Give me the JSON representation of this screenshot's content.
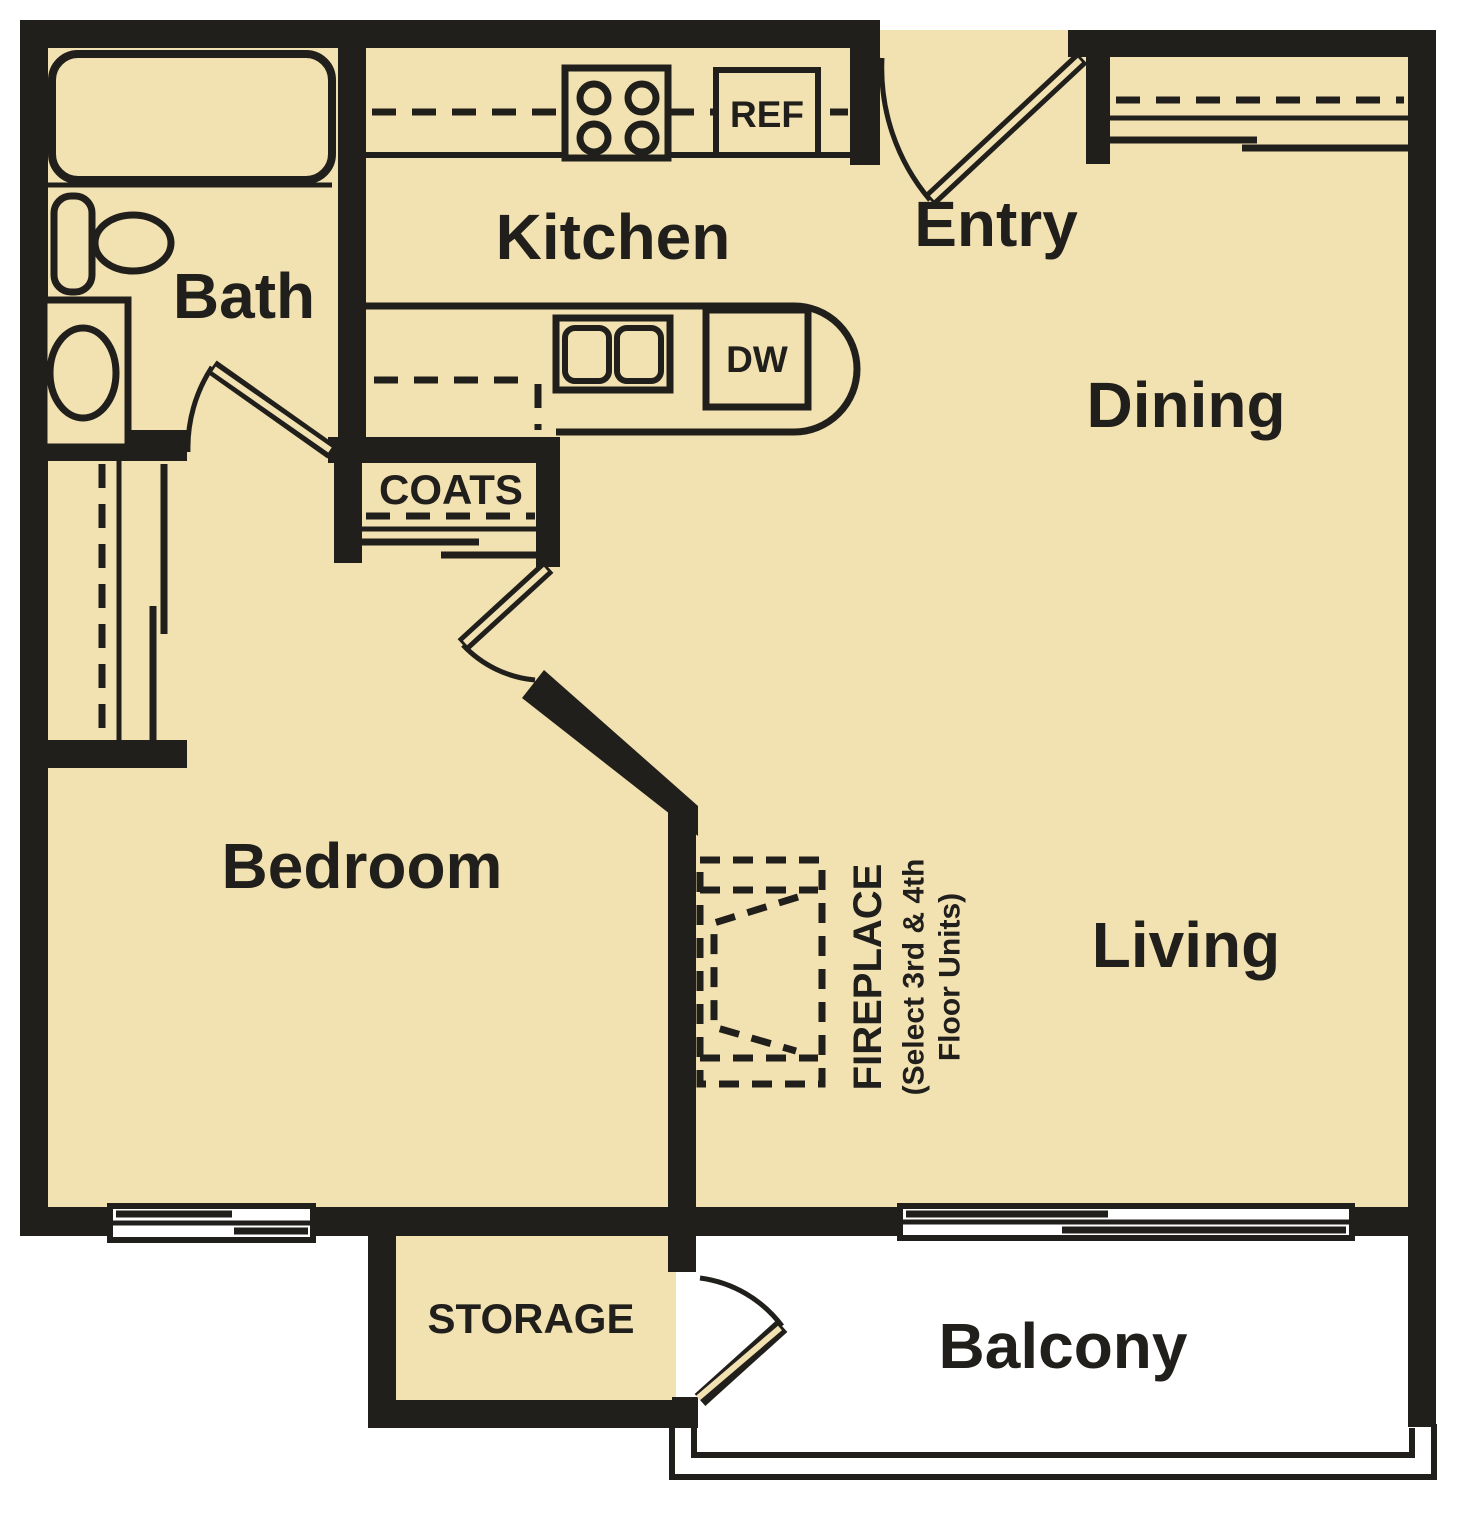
{
  "colors": {
    "floor": "#F2E2B1",
    "wall": "#211F1B",
    "line": "#211F1B",
    "outside": "#FFFFFF"
  },
  "labels": {
    "bath": "Bath",
    "kitchen": "Kitchen",
    "entry": "Entry",
    "dining": "Dining",
    "bedroom": "Bedroom",
    "living": "Living",
    "balcony": "Balcony",
    "storage": "STORAGE",
    "coats": "COATS",
    "ref": "REF",
    "dw": "DW",
    "fireplace": "FIREPLACE",
    "fireplace_note1": "(Select 3rd & 4th",
    "fireplace_note2": "Floor Units)"
  }
}
